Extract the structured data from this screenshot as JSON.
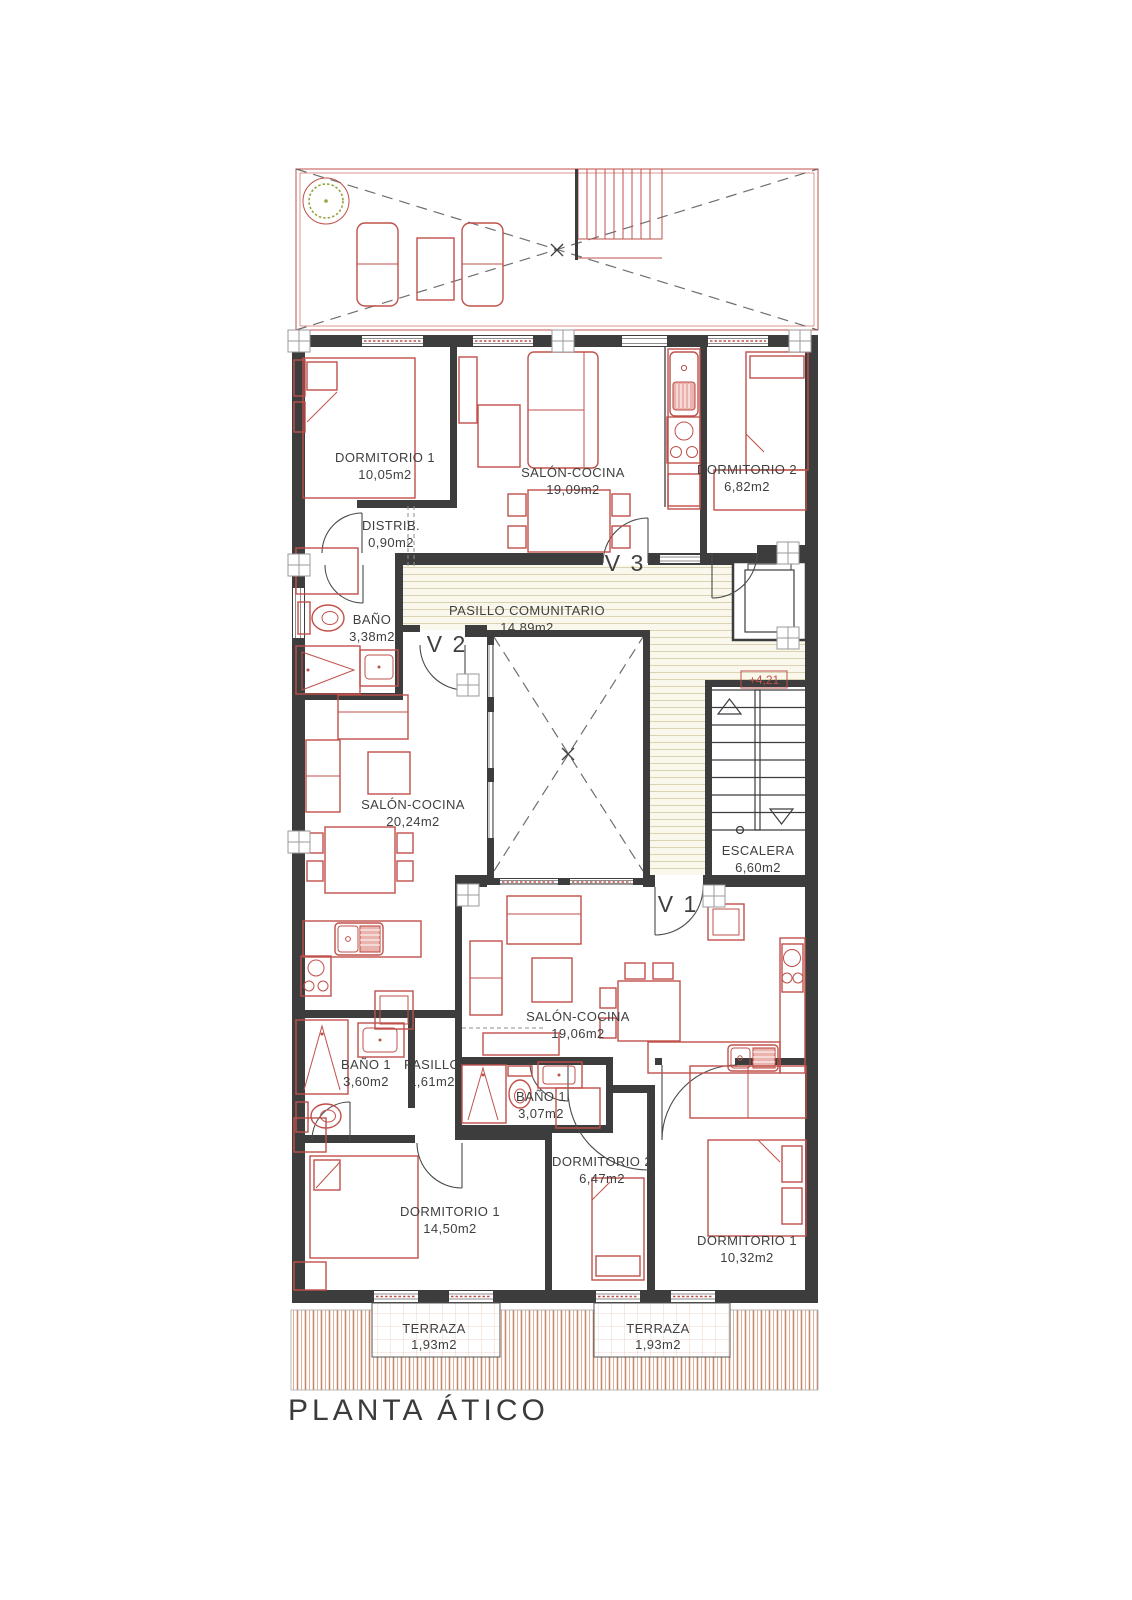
{
  "title": "PLANTA ÁTICO",
  "level_marker": "+4,21",
  "doors": {
    "v1": "V 1",
    "v2": "V 2",
    "v3": "V 3"
  },
  "common": {
    "pasillo_comunitario": {
      "name": "PASILLO COMUNITARIO",
      "area": "14,89m2"
    },
    "escalera": {
      "name": "ESCALERA",
      "area": "6,60m2"
    }
  },
  "apartment_a": {
    "dormitorio1": {
      "name": "DORMITORIO 1",
      "area": "10,05m2"
    },
    "salon_cocina": {
      "name": "SALÓN-COCINA",
      "area": "19,09m2"
    },
    "dormitorio2": {
      "name": "DORMITORIO 2",
      "area": "6,82m2"
    },
    "distribuidor": {
      "name": "DISTRIB.",
      "area": "0,90m2"
    },
    "bano": {
      "name": "BAÑO",
      "area": "3,38m2"
    }
  },
  "apartment_b": {
    "salon_cocina": {
      "name": "SALÓN-COCINA",
      "area": "20,24m2"
    },
    "bano1": {
      "name": "BAÑO 1",
      "area": "3,60m2"
    },
    "pasillo": {
      "name": "PASILLO",
      "area": "1,61m2"
    },
    "dormitorio1": {
      "name": "DORMITORIO 1",
      "area": "14,50m2"
    },
    "terraza": {
      "name": "TERRAZA",
      "area": "1,93m2"
    }
  },
  "apartment_c": {
    "salon_cocina": {
      "name": "SALÓN-COCINA",
      "area": "19,06m2"
    },
    "bano1": {
      "name": "BAÑO 1",
      "area": "3,07m2"
    },
    "dormitorio2": {
      "name": "DORMITORIO 2",
      "area": "6,47m2"
    },
    "dormitorio1": {
      "name": "DORMITORIO 1",
      "area": "10,32m2"
    },
    "terraza": {
      "name": "TERRAZA",
      "area": "1,93m2"
    }
  },
  "colors": {
    "wall": "#3d3d3d",
    "fixture_red": "#c0504a",
    "fixture_fill": "#eab3ae",
    "corridor_hatch": "#d9d3b2",
    "deck_hatch": "#c9886c",
    "tree_green": "#9aa23d"
  }
}
